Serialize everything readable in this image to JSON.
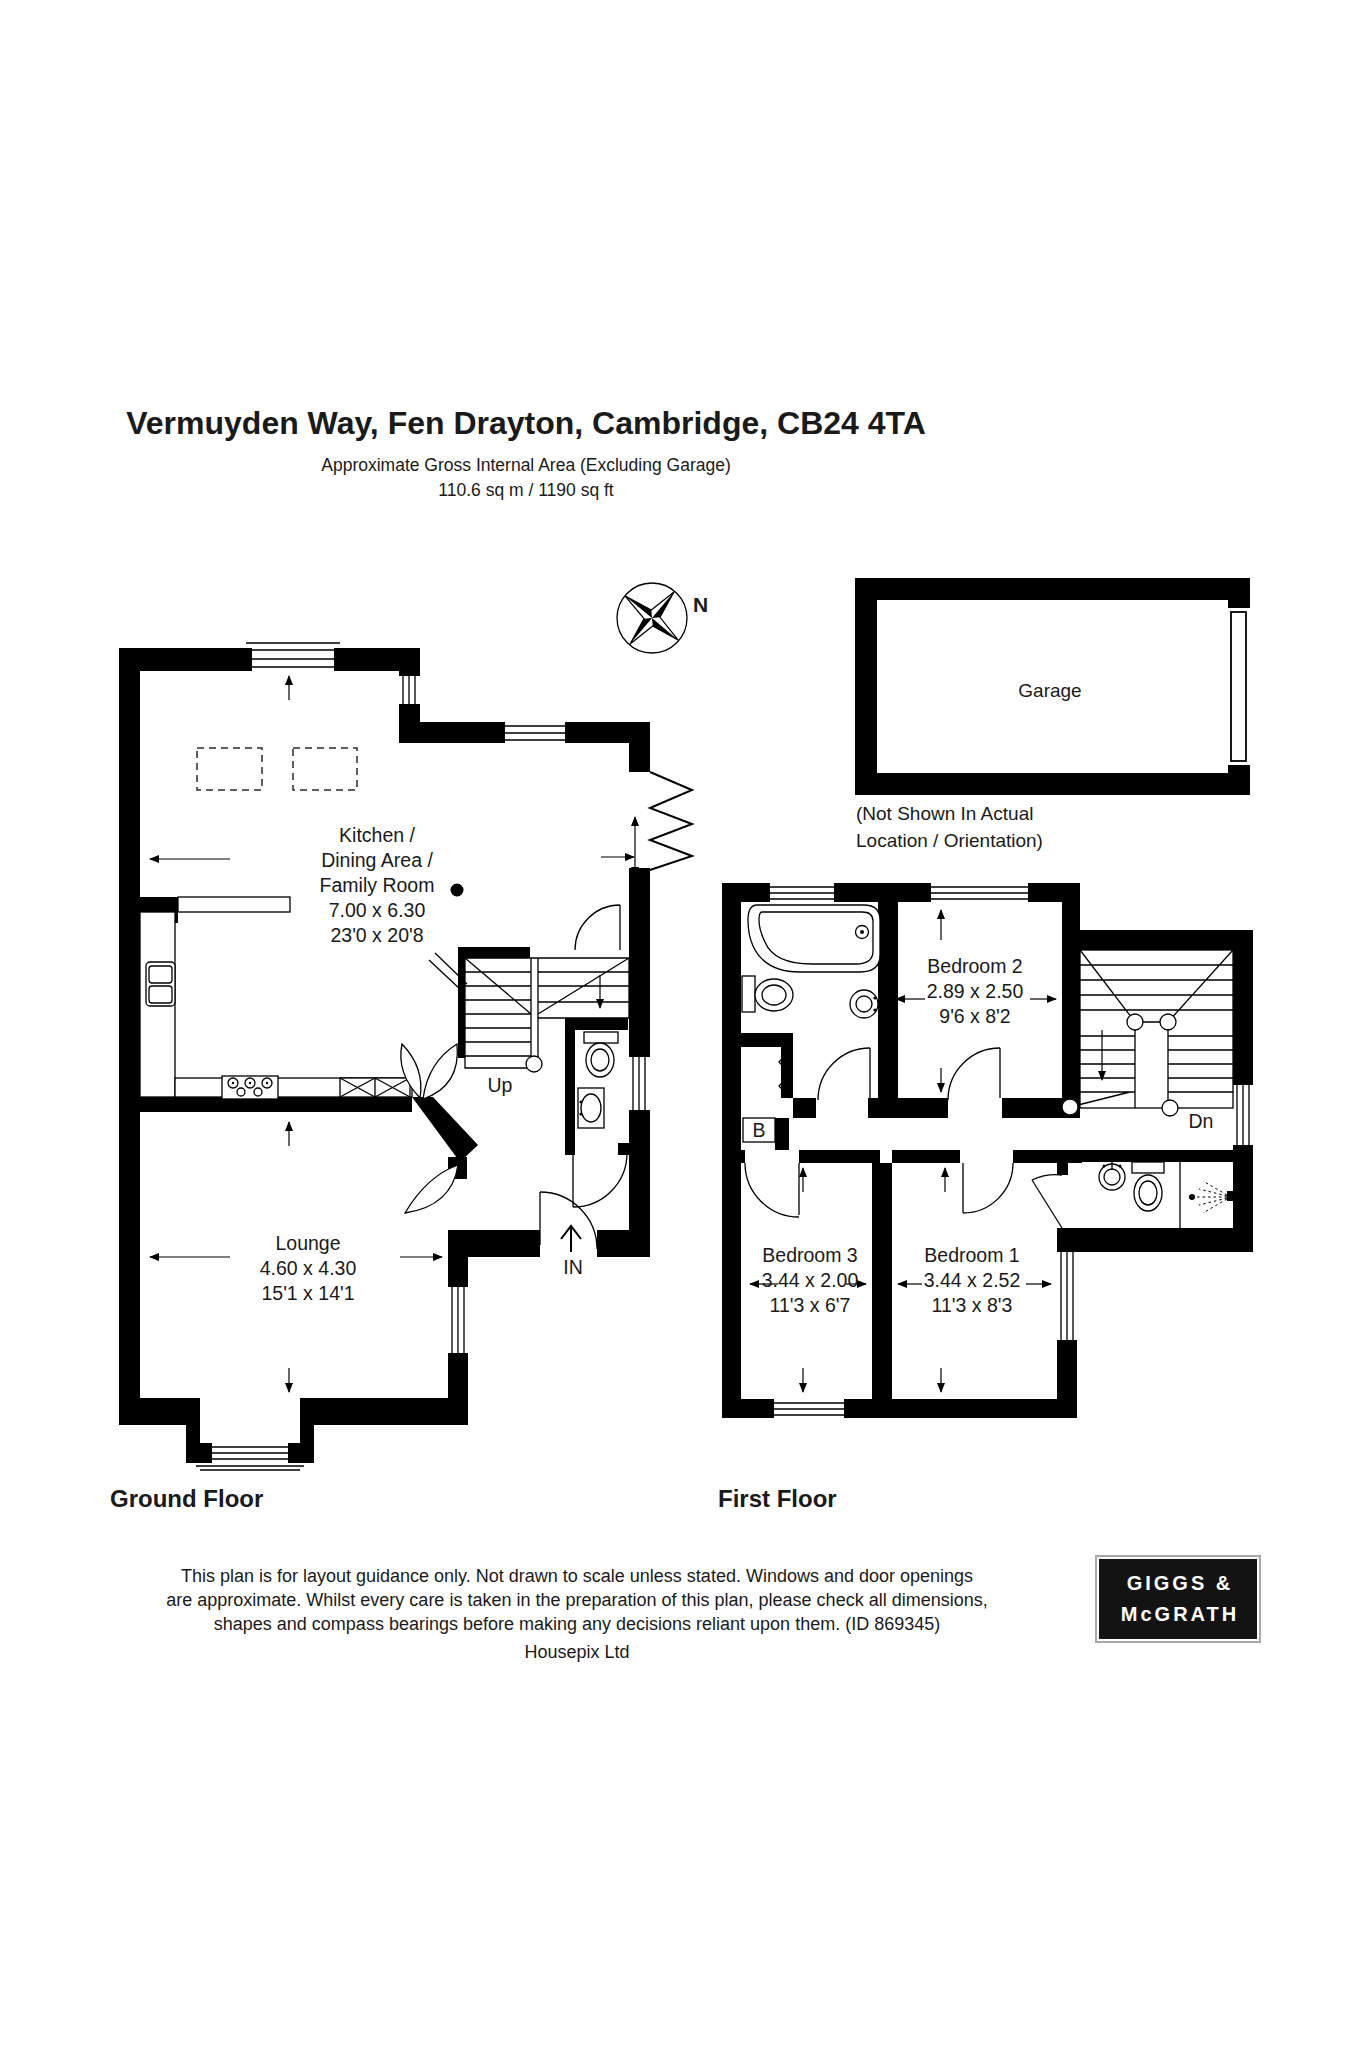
{
  "header": {
    "title": "Vermuyden Way, Fen Drayton, Cambridge, CB24 4TA",
    "subtitle": "Approximate Gross Internal Area (Excluding Garage)",
    "area": "110.6 sq m / 1190 sq ft"
  },
  "compass": {
    "north": "N"
  },
  "garage": {
    "label": "Garage",
    "note1": "(Not Shown In Actual",
    "note2": "Location / Orientation)"
  },
  "ground_floor": {
    "caption": "Ground Floor",
    "kitchen": {
      "line1": "Kitchen /",
      "line2": "Dining Area /",
      "line3": "Family Room",
      "metric": "7.00 x 6.30",
      "imperial": "23'0 x 20'8"
    },
    "lounge": {
      "name": "Lounge",
      "metric": "4.60 x 4.30",
      "imperial": "15'1 x 14'1"
    },
    "up": "Up",
    "entrance": "IN"
  },
  "first_floor": {
    "caption": "First Floor",
    "bedroom2": {
      "name": "Bedroom 2",
      "metric": "2.89 x 2.50",
      "imperial": "9'6 x 8'2"
    },
    "bedroom3": {
      "name": "Bedroom 3",
      "metric": "3.44 x 2.00",
      "imperial": "11'3 x 6'7"
    },
    "bedroom1": {
      "name": "Bedroom 1",
      "metric": "3.44 x 2.52",
      "imperial": "11'3 x 8'3"
    },
    "down": "Dn",
    "boiler": "B"
  },
  "footer": {
    "line1": "This plan is for layout guidance only. Not drawn to scale unless stated. Windows and door openings",
    "line2": "are approximate. Whilst every care is taken in the preparation of this plan, please check all dimensions,",
    "line3": "shapes and compass bearings before making any decisions reliant upon them. (ID 869345)",
    "credit": "Housepix Ltd"
  },
  "logo": {
    "line1": "GIGGS &",
    "line2": "McGRATH"
  },
  "colors": {
    "wall": "#000000",
    "background": "#ffffff",
    "text": "#1a1a1a",
    "logo_bg": "#131313",
    "logo_border": "#a9a9a9"
  }
}
